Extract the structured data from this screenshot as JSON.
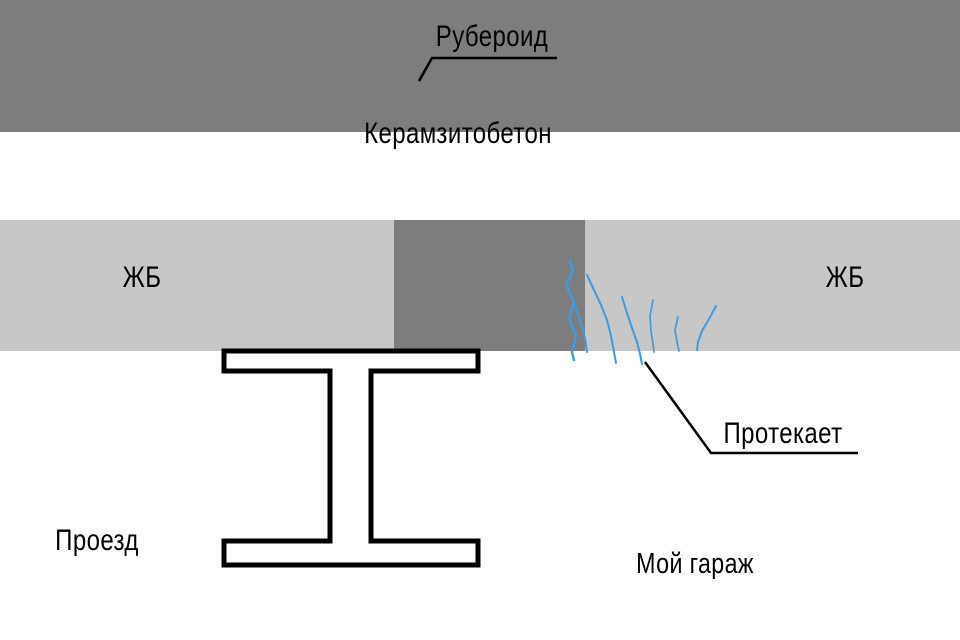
{
  "diagram": {
    "description": "Hand-drawn construction cross-section of a garage roof leaking at a seam",
    "labels": {
      "roof_membrane": "Рубероид",
      "insulation_layer": "Керамзитобетон",
      "slab_left": "ЖБ",
      "slab_right": "ЖБ",
      "leak": "Протекает",
      "driveway": "Проезд",
      "garage": "Мой гараж"
    },
    "colors": {
      "background": "#ffffff",
      "roof_membrane_line": "#000000",
      "insulation_dark_gray": "#7d7d7d",
      "slab_light_gray": "#c7c7c7",
      "leak_crack_blue": "#3f9ae0",
      "outline_black": "#000000",
      "text": "#000000"
    }
  }
}
